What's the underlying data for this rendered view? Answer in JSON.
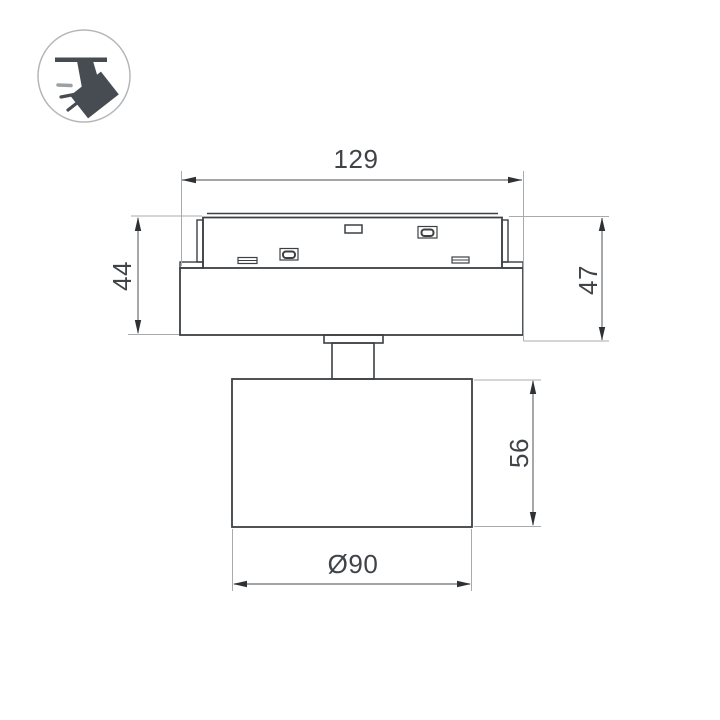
{
  "drawing": {
    "kind": "technical-dimension-drawing",
    "subject": "ceiling track spotlight, side view",
    "dimensions": {
      "track_width": "129",
      "base_height_left": "44",
      "base_height_right": "47",
      "head_height": "56",
      "head_diameter": "Ø90"
    },
    "colors": {
      "background": "#ffffff",
      "outline": "#3c4043",
      "dimension_line": "#6a6d70",
      "extension_line": "#a8abad",
      "arrow": "#2f3235",
      "text": "#404448",
      "icon_fill": "#474c52",
      "icon_ray_gray": "#9ba0a3",
      "icon_circle_stroke": "#b4b7b9"
    }
  },
  "icon": {
    "name": "track-spotlight-pictogram"
  }
}
